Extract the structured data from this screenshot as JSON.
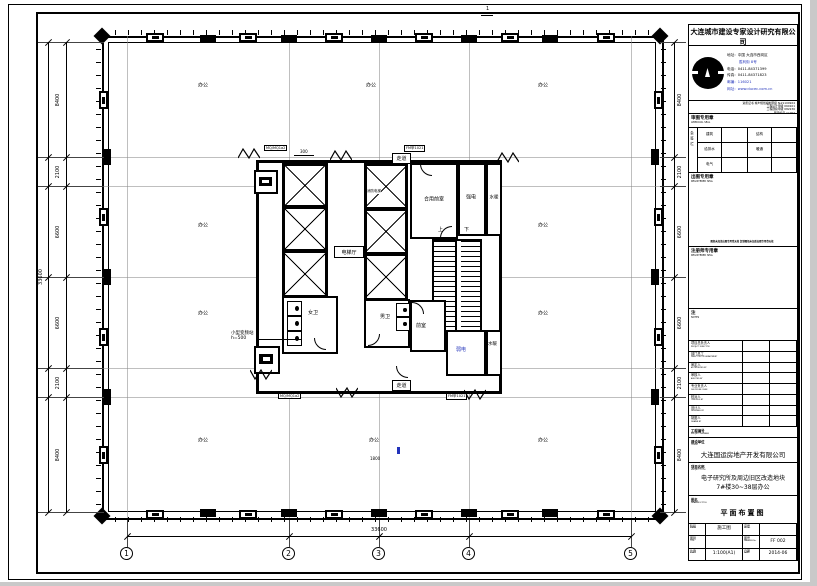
{
  "colors": {
    "ink": "#000000",
    "blue": "#2233bb",
    "paper": "#ffffff"
  },
  "fold_mark": "1",
  "plan": {
    "office_label": "办公",
    "rooms": {
      "fire_elevator": "消防电梯",
      "shared_lobby": "合用前室",
      "strong_electric": "强电",
      "water_heating_top": "水暖",
      "elevator_hall": "电梯厅",
      "corridor_top": "走道",
      "corridor_bottom": "走道",
      "womens_wc": "女卫",
      "mens_wc": "男卫",
      "front_room": "前室",
      "weak_electric": "弱电",
      "water_heating_bottom": "水暖",
      "stair_up": "上",
      "stair_down": "下"
    },
    "callout": {
      "line1": "小型变频站",
      "line2": "h=500"
    },
    "tags": {
      "t1": "MQ/MQ1a2",
      "t2": "FM甲1021",
      "t3": "MQ/MQ1a2",
      "t4": "FM甲1021",
      "dim_300": "300",
      "dim_1800": "1800"
    },
    "dims": {
      "left": [
        "8400",
        "2100",
        "6600",
        "6600",
        "2100",
        "8400"
      ],
      "right": [
        "8400",
        "2100",
        "6600",
        "6600",
        "2100",
        "8400"
      ],
      "left_total": "33600",
      "bottom_total": "33600",
      "grid_cols": [
        "1",
        "2",
        "3",
        "4",
        "5"
      ]
    }
  },
  "titleblock": {
    "company_cn": "大连城市建设专家设计研究有限公司",
    "company_en": "DALIAN URBAN CONSTRUCTION EXPERT CO.,LTD",
    "contact": {
      "address1": "地址：中国 大连市西岗区",
      "address2": "胜利街 8号",
      "tel": "电话：0411-84371399",
      "fax": "传真：0411-84371823",
      "zip": "邮编：116021",
      "web": "网址：www.ducec.com.cn"
    },
    "certs": [
      "资质证书 城乡规划编制甲级 №21100924",
      "工程设计甲级 060101",
      "工程勘察甲级 082236",
      "图审编号 AJ-002"
    ],
    "examine_seal": {
      "cn": "审图专用章",
      "en": "APPROVAL SEAL"
    },
    "huiqian": {
      "side": "会签栏",
      "rows": [
        [
          "建筑",
          "",
          "结构",
          ""
        ],
        [
          "给排水",
          "",
          "暖通",
          ""
        ],
        [
          "电气",
          "",
          "",
          ""
        ]
      ]
    },
    "plot_seal": {
      "cn": "出图专用章",
      "en": "REGISTERED SEAL",
      "note": "图纸未加盖出图专用章无效 复制图纸未加盖出图专用章无效"
    },
    "reg_seal": {
      "cn": "注册师专用章",
      "en": "REGISTERED SEAL"
    },
    "notes": {
      "cn": "注",
      "en": "NOTES"
    },
    "personnel": [
      [
        "项目总负责人",
        "PROJECT DIRECTOR"
      ],
      [
        "部门总工",
        "DIRECTOR OF DEPARTMENT"
      ],
      [
        "审定人",
        "AUTHORIZED BY"
      ],
      [
        "审核人",
        "AUDITED BY"
      ],
      [
        "专业负责人",
        "DISCIPLINE CHIEF"
      ],
      [
        "校对人",
        "CHECKED BY"
      ],
      [
        "设计人",
        "DESIGNED BY"
      ],
      [
        "制图人",
        "DRAWN BY"
      ]
    ],
    "project_number": {
      "cn": "工程编号",
      "en": "PROJECT NUMBER",
      "value": ""
    },
    "client": {
      "cn": "建设单位",
      "en": "CLIENT",
      "value": "大连国运房地产开发有限公司"
    },
    "project": {
      "cn": "项目名称",
      "en": "PROJECT TITLE",
      "line1": "电子研究所及周边旧区改造地块",
      "line2": "7#楼30~38层办公"
    },
    "drawing": {
      "cn": "图名",
      "en": "DRAWING TITLE",
      "value": "平面布置图"
    },
    "info": {
      "stage": {
        "cn": "阶段",
        "en": "STAGE",
        "value": "施工图"
      },
      "serial": {
        "cn": "序号",
        "en": "SERIAL",
        "value": ""
      },
      "type": {
        "cn": "图别",
        "en": "TYPE",
        "value": ""
      },
      "number": {
        "cn": "图号",
        "en": "DRAWING No.",
        "value": "FF 002"
      },
      "scale": {
        "cn": "比例",
        "en": "SCALE",
        "value": "1:100(A1)"
      },
      "date": {
        "cn": "日期",
        "en": "DATE",
        "value": "2014-06"
      }
    }
  }
}
